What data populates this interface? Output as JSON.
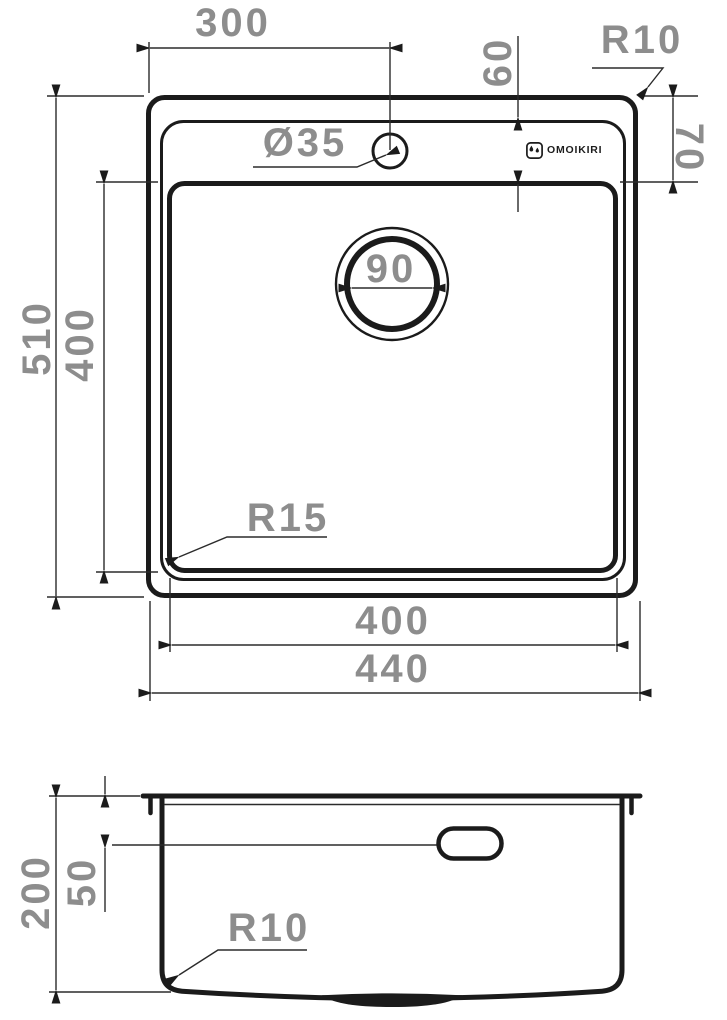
{
  "drawing": {
    "brand": "OMOIKIRI",
    "colors": {
      "line": "#1b1b1b",
      "dim_text": "#8d8d8d"
    },
    "top_view": {
      "dims": {
        "faucet_offset": "300",
        "deck_height": "60",
        "outer_corner_radius": "R10",
        "rim_offset": "70",
        "faucet_hole": "Ø35",
        "drain_diameter": "90",
        "overall_height": "510",
        "bowl_height": "400",
        "bowl_corner_radius": "R15",
        "bowl_width": "400",
        "overall_width": "440"
      }
    },
    "section_view": {
      "dims": {
        "overall_depth": "200",
        "overflow_offset": "50",
        "bottom_corner_radius": "R10"
      }
    }
  }
}
